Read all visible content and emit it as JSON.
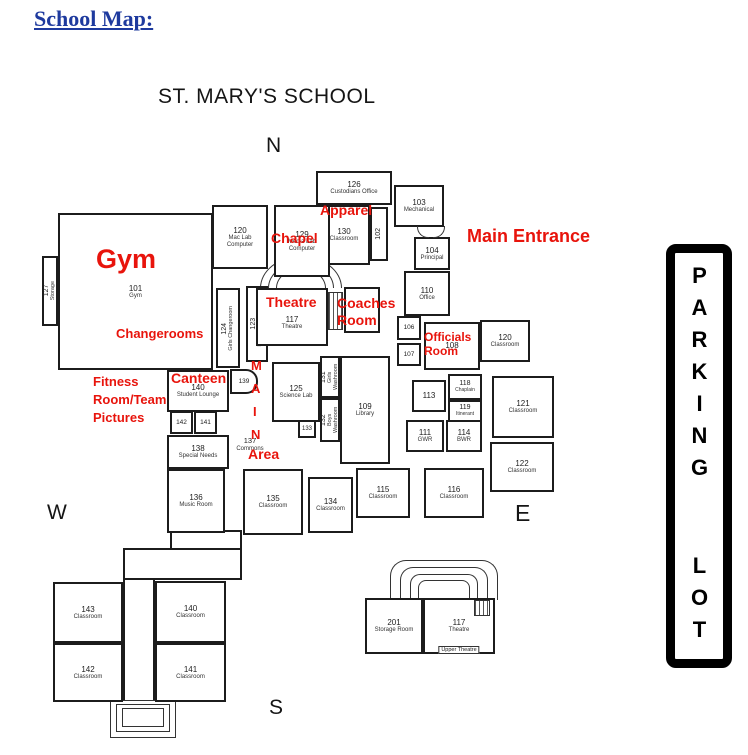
{
  "title": {
    "page": "School Map:",
    "map": "ST. MARY'S SCHOOL"
  },
  "compass": {
    "n": "N",
    "s": "S",
    "e": "E",
    "w": "W"
  },
  "parking": {
    "word1": "PARKING",
    "word2": "LOT"
  },
  "colors": {
    "annotation_red": "#e8140c",
    "title_blue": "#1e3a9e",
    "line_black": "#1c1c1c"
  },
  "annotations": {
    "gym": "Gym",
    "chapel": "Chapel",
    "apparel": "Apparel",
    "main_entrance": "Main Entrance",
    "theatre": "Theatre",
    "coaches_line1": "Coaches",
    "coaches_line2": "Room",
    "changerooms": "Changerooms",
    "officials_line1": "Officials",
    "officials_line2": "Room",
    "fitness_line1": "Fitness",
    "fitness_line2": "Room/Team",
    "fitness_line3": "Pictures",
    "canteen": "Canteen",
    "main_m": "M",
    "main_a": "A",
    "main_i": "I",
    "main_n": "N",
    "area": "Area"
  },
  "rooms": {
    "r126": {
      "num": "126",
      "sub": "Custodians Office"
    },
    "r103": {
      "num": "103",
      "sub": "Mechanical"
    },
    "r130": {
      "num": "130",
      "sub": "Classroom"
    },
    "r120lab": {
      "num": "120",
      "sub": "Mac Lab Computer"
    },
    "r129": {
      "num": "129",
      "sub": "Media Lab Computer"
    },
    "r102": {
      "num": "102"
    },
    "r104": {
      "num": "104",
      "sub": "Principal"
    },
    "r110": {
      "num": "110",
      "sub": "Office"
    },
    "r106": {
      "num": "106"
    },
    "r107": {
      "num": "107"
    },
    "r108": {
      "num": "108"
    },
    "r120e": {
      "num": "120",
      "sub": "Classroom"
    },
    "r101": {
      "num": "101",
      "sub": "Gym"
    },
    "r127": {
      "num": "127",
      "sub": "Storage"
    },
    "r124": {
      "num": "124",
      "sub": "Girls Changeroom"
    },
    "r123": {
      "num": "123",
      "sub": "Boys Changeroom"
    },
    "r117": {
      "num": "117",
      "sub": "Theatre"
    },
    "r125": {
      "num": "125",
      "sub": "Science Lab"
    },
    "r131": {
      "num": "131",
      "sub": "Girls Washroom"
    },
    "r132": {
      "num": "132",
      "sub": "Boys Washroom"
    },
    "r133": {
      "num": "133"
    },
    "r109": {
      "num": "109",
      "sub": "Library"
    },
    "r137": {
      "num": "137",
      "sub": "Commons"
    },
    "r113": {
      "num": "113"
    },
    "r118": {
      "num": "118",
      "sub": "Chaplain"
    },
    "r119": {
      "num": "119",
      "sub": "Itinerant"
    },
    "r111": {
      "num": "111",
      "sub": "GWR"
    },
    "r114": {
      "num": "114",
      "sub": "BWR"
    },
    "r121": {
      "num": "121",
      "sub": "Classroom"
    },
    "r122": {
      "num": "122",
      "sub": "Classroom"
    },
    "r140n": {
      "num": "140",
      "sub": "Student Lounge"
    },
    "r139": {
      "num": "139"
    },
    "r142n": {
      "num": "142"
    },
    "r141n": {
      "num": "141"
    },
    "r138": {
      "num": "138",
      "sub": "Special Needs"
    },
    "r136": {
      "num": "136",
      "sub": "Music Room"
    },
    "r135": {
      "num": "135",
      "sub": "Classroom"
    },
    "r134": {
      "num": "134",
      "sub": "Classroom"
    },
    "r115": {
      "num": "115",
      "sub": "Classroom"
    },
    "r116": {
      "num": "116",
      "sub": "Classroom"
    },
    "r143": {
      "num": "143",
      "sub": "Classroom"
    },
    "r140s": {
      "num": "140",
      "sub": "Classroom"
    },
    "r142s": {
      "num": "142",
      "sub": "Classroom"
    },
    "r141s": {
      "num": "141",
      "sub": "Classroom"
    },
    "r201": {
      "num": "201",
      "sub": "Storage Room"
    },
    "r117u": {
      "num": "117",
      "sub": "Theatre",
      "caption": "Upper Theatre"
    }
  }
}
